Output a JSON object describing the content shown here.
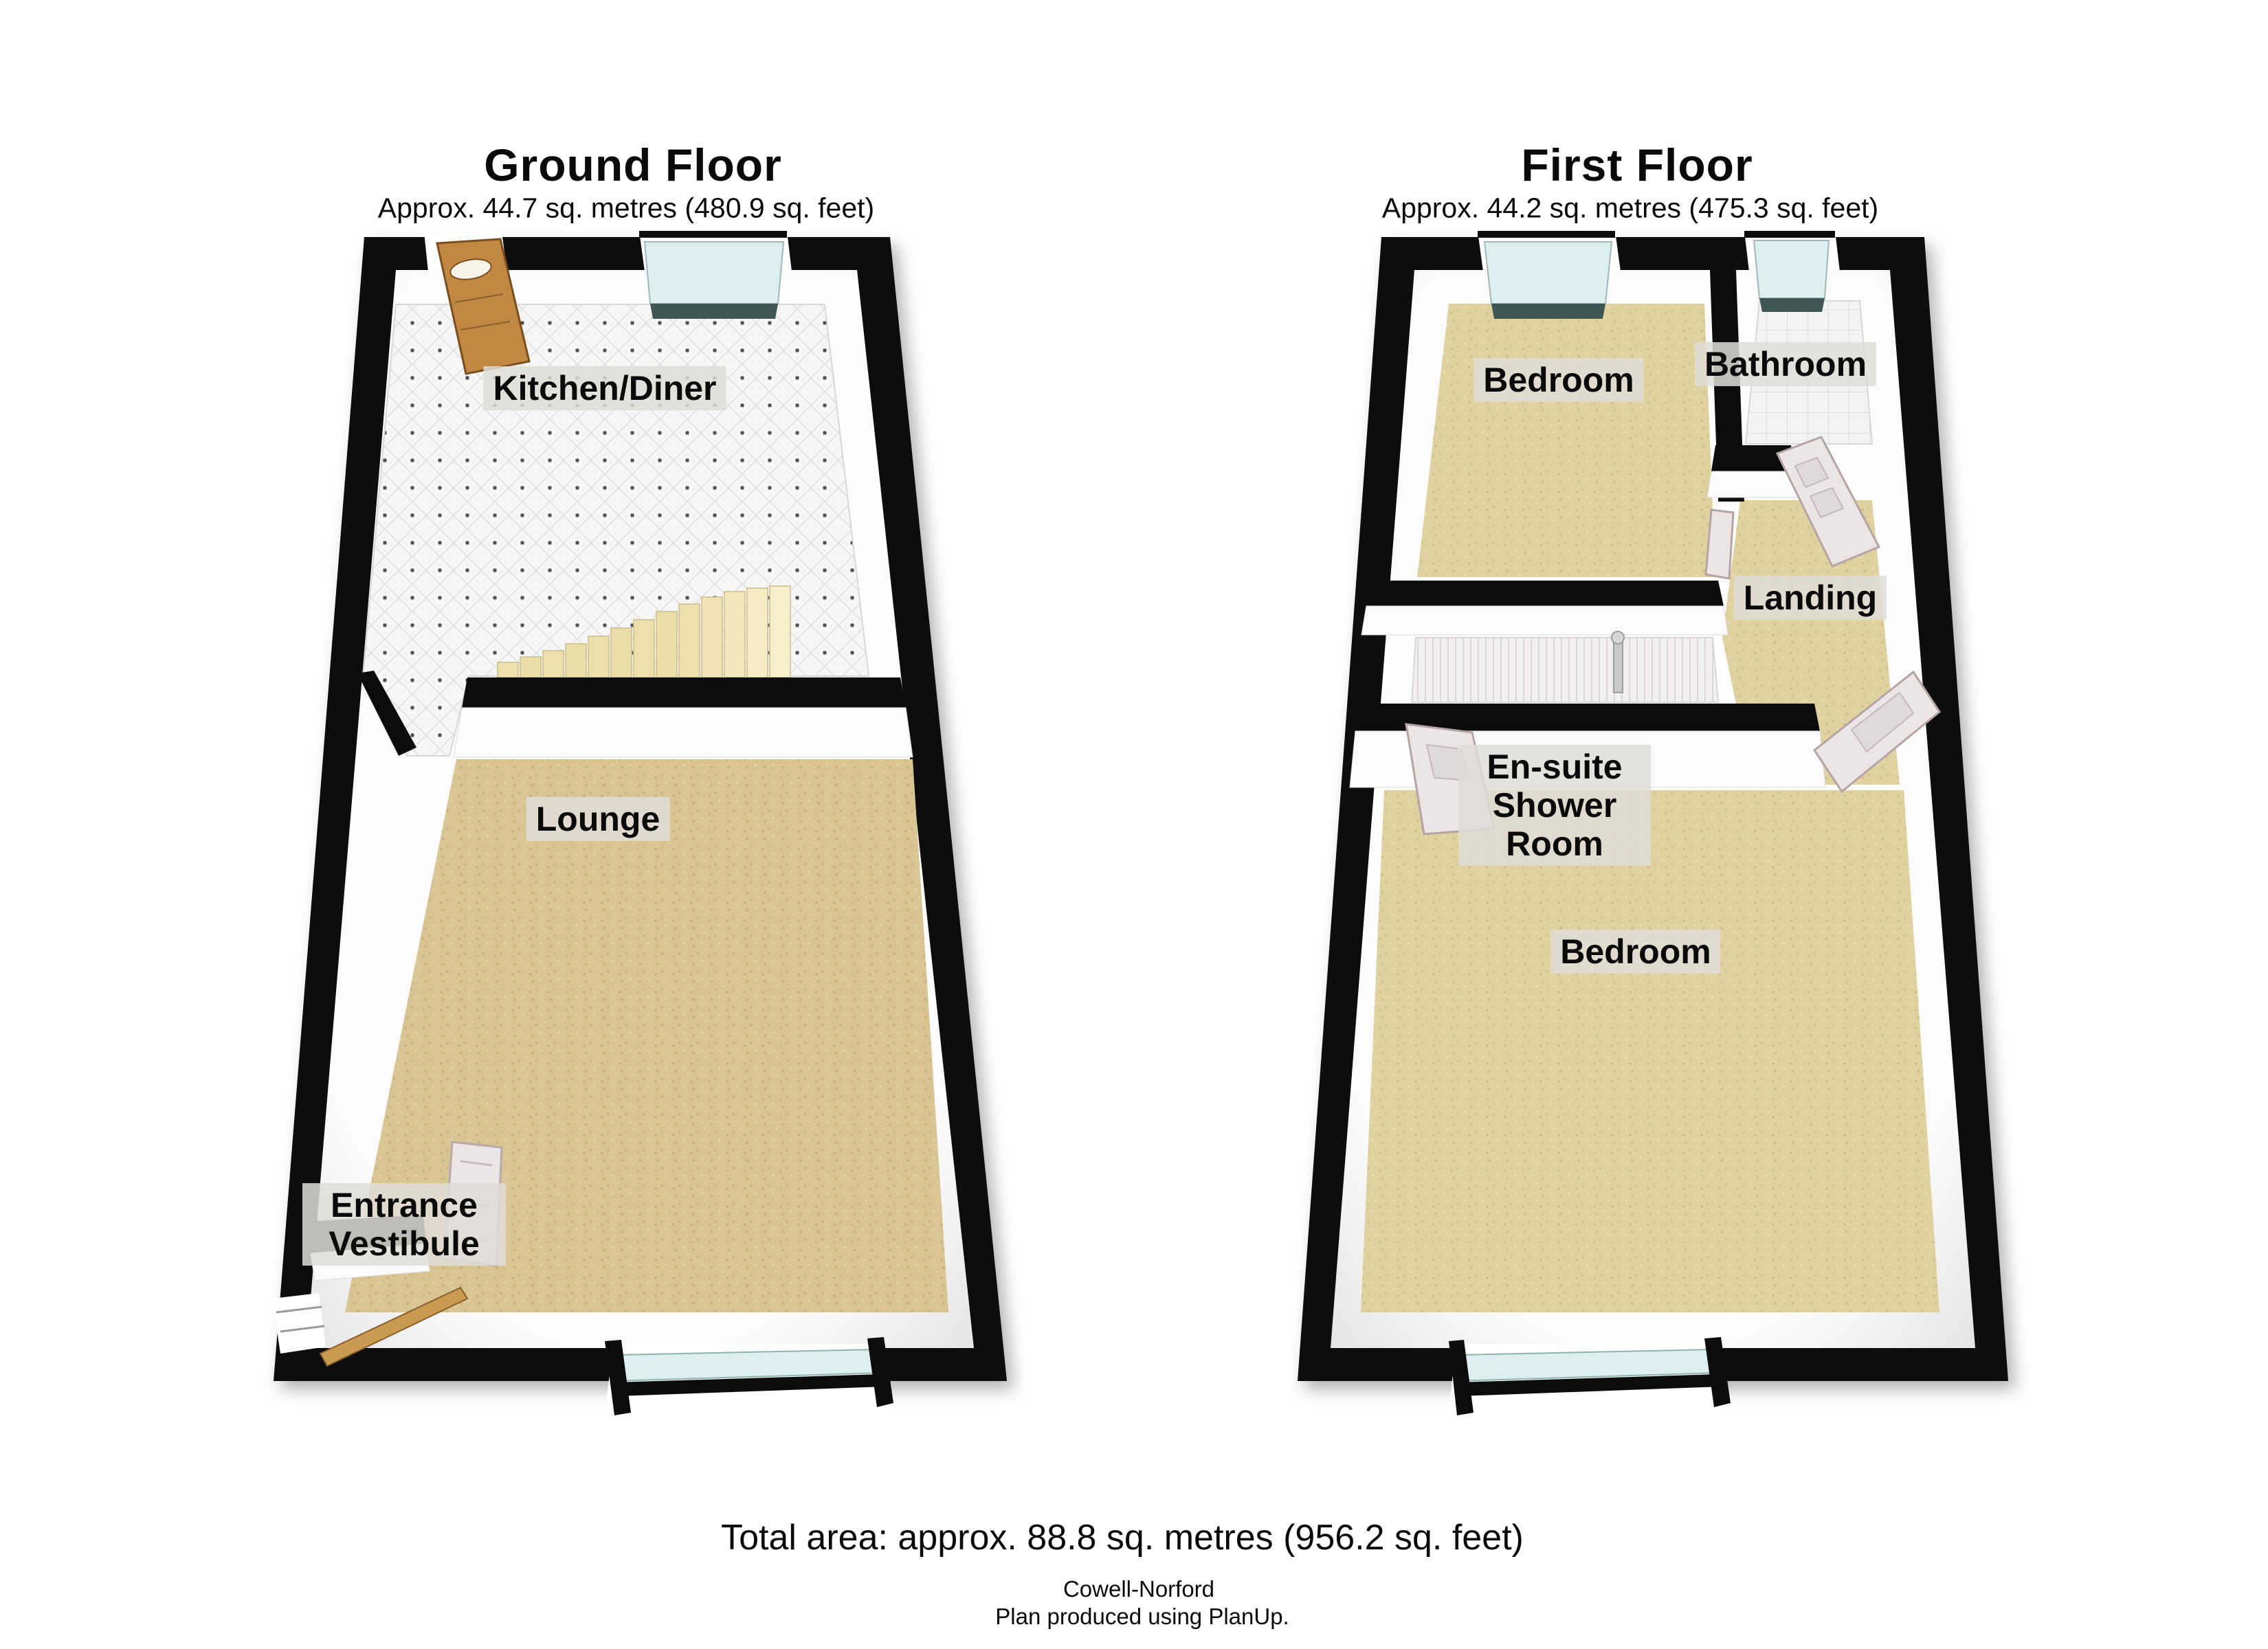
{
  "ground_floor": {
    "title": "Ground Floor",
    "area": "Approx. 44.7 sq. metres (480.9 sq. feet)",
    "rooms": {
      "kitchen_diner": "Kitchen/Diner",
      "lounge": "Lounge",
      "entrance_vestibule": "Entrance Vestibule"
    }
  },
  "first_floor": {
    "title": "First Floor",
    "area": "Approx. 44.2 sq. metres (475.3 sq. feet)",
    "rooms": {
      "bedroom_front": "Bedroom",
      "bathroom": "Bathroom",
      "landing": "Landing",
      "ensuite_shower_room": "En-suite Shower Room",
      "bedroom_rear": "Bedroom"
    }
  },
  "summary": {
    "total_area": "Total area: approx. 88.8 sq. metres (956.2 sq. feet)",
    "agent_name": "Cowell-Norford",
    "credit_line": "Plan produced using PlanUp."
  },
  "colors": {
    "wall": "#0c0c0c",
    "carpet_ground": "#d9c594",
    "carpet_first": "#e0d1a0",
    "kitchen_tile": "#f6f6f6",
    "bath_tile": "#f3f3f3",
    "window_glass": "#ddeff0",
    "window_sill": "#3f5654",
    "stairs": "#e9dda8",
    "wood_door": "#c08843",
    "white_door": "#ece5e6",
    "label_background": "#dfddd7"
  }
}
